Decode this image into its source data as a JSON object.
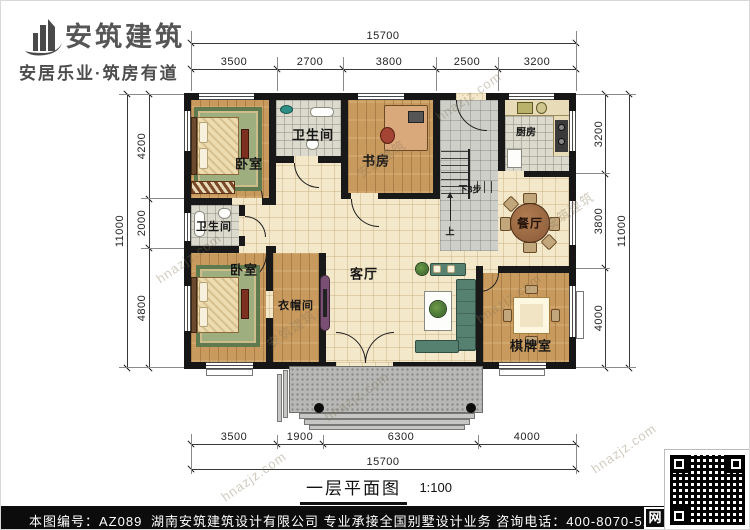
{
  "header": {
    "brand": "安筑建筑",
    "tagline": "安居乐业·筑房有道"
  },
  "dims": {
    "top": {
      "total": "15700",
      "segments": [
        "3500",
        "2700",
        "3800",
        "2500",
        "3200"
      ]
    },
    "bottom": {
      "total": "15700",
      "segments": [
        "3500",
        "1900",
        "6300",
        "4000"
      ]
    },
    "left": {
      "total": "11000",
      "segments": [
        "4200",
        "2000",
        "4800"
      ]
    },
    "right": {
      "total": "11000",
      "segments": [
        "3200",
        "3800",
        "4000"
      ]
    }
  },
  "rooms": {
    "bedroom": "卧室",
    "bathroom": "卫生间",
    "study": "书房",
    "kitchen": "厨房",
    "dining": "餐厅",
    "cloakroom": "衣帽间",
    "living": "客厅",
    "chess": "棋牌室"
  },
  "stairs": {
    "down": "下3步",
    "up": "上"
  },
  "title": {
    "name": "一层平面图",
    "scale": "1:100"
  },
  "footer": {
    "number": "本图编号：AZ089",
    "company": "湖南安筑建筑设计有限公司  专业承接全国别墅设计业务  咨询电话：400-8070-511",
    "web": "网"
  },
  "watermark": {
    "brand": "安筑建筑",
    "site": "hnazjz.com"
  },
  "colors": {
    "wall": "#161616",
    "wood_floor": "#c89a5e",
    "tile_floor": "#f4e8cb",
    "wet_tile": "#dcd9cd",
    "porch": "#b8b8b6",
    "rug_green": "#5e7a4e",
    "sofa_teal": "#56806f",
    "table_brown": "#9b6a45",
    "footer_bg": "#0c0c0c"
  }
}
